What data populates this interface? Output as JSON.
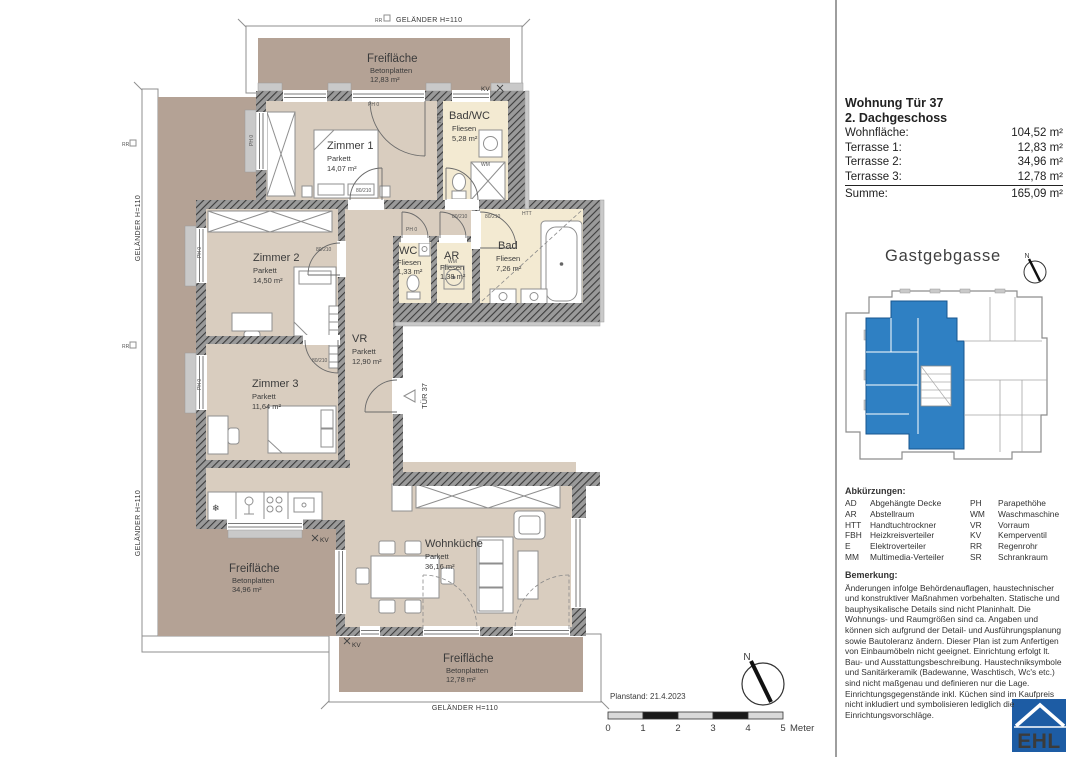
{
  "colors": {
    "terrace": "#b4a295",
    "room": "#d9cdbf",
    "wet": "#f3ead2",
    "unit_blue": "#2f80c3",
    "logo_blue": "#1d5ca4"
  },
  "plan": {
    "rooms": [
      {
        "name": "Zimmer 1",
        "floor": "Parkett",
        "area": "14,07 m²"
      },
      {
        "name": "Bad/WC",
        "floor": "Fliesen",
        "area": "5,28 m²"
      },
      {
        "name": "Zimmer 2",
        "floor": "Parkett",
        "area": "14,50 m²"
      },
      {
        "name": "WC",
        "floor": "Fliesen",
        "area": "1,33 m²"
      },
      {
        "name": "AR",
        "floor": "Fliesen",
        "area": "1,38 m²"
      },
      {
        "name": "Bad",
        "floor": "Fliesen",
        "area": "7,26 m²"
      },
      {
        "name": "VR",
        "floor": "Parkett",
        "area": "12,90 m²"
      },
      {
        "name": "Zimmer 3",
        "floor": "Parkett",
        "area": "11,64 m²"
      },
      {
        "name": "Wohnküche",
        "floor": "Parkett",
        "area": "36,16 m²"
      }
    ],
    "terraces": [
      {
        "name": "Freifläche",
        "material": "Betonplatten",
        "area": "12,83 m²"
      },
      {
        "name": "Freifläche",
        "material": "Betonplatten",
        "area": "34,96 m²"
      },
      {
        "name": "Freifläche",
        "material": "Betonplatten",
        "area": "12,78 m²"
      }
    ],
    "railing_label": "GELÄNDER H=110",
    "door_label": "TÜR 37",
    "marks": {
      "kv": "KV",
      "rr": "RR",
      "htt": "HTT",
      "wm": "WM",
      "ph": "PH 0",
      "door_dim": "80/210",
      "north": "N"
    },
    "planstand": "Planstand: 21.4.2023",
    "scale": {
      "ticks": [
        "0",
        "1",
        "2",
        "3",
        "4",
        "5"
      ],
      "unit": "Meter"
    }
  },
  "panel": {
    "title": "Wohnung Tür 37",
    "subtitle": "2. Dachgeschoss",
    "rows": [
      {
        "label": "Wohnfläche:",
        "value": "104,52 m²"
      },
      {
        "label": "Terrasse 1:",
        "value": "12,83 m²"
      },
      {
        "label": "Terrasse 2:",
        "value": "34,96 m²"
      },
      {
        "label": "Terrasse 3:",
        "value": "12,78 m²"
      }
    ],
    "total": {
      "label": "Summe:",
      "value": "165,09 m²"
    },
    "street": "Gastgebgasse"
  },
  "abbreviations": {
    "title": "Abkürzungen:",
    "items": [
      {
        "abbr": "AD",
        "term": "Abgehängte Decke"
      },
      {
        "abbr": "PH",
        "term": "Parapethöhe"
      },
      {
        "abbr": "AR",
        "term": "Abstellraum"
      },
      {
        "abbr": "WM",
        "term": "Waschmaschine"
      },
      {
        "abbr": "HTT",
        "term": "Handtuchtrockner"
      },
      {
        "abbr": "VR",
        "term": "Vorraum"
      },
      {
        "abbr": "FBH",
        "term": "Heizkreisverteiler"
      },
      {
        "abbr": "KV",
        "term": "Kemperventil"
      },
      {
        "abbr": "E",
        "term": "Elektroverteiler"
      },
      {
        "abbr": "RR",
        "term": "Regenrohr"
      },
      {
        "abbr": "MM",
        "term": "Multimedia-Verteiler"
      },
      {
        "abbr": "SR",
        "term": "Schrankraum"
      }
    ]
  },
  "remark": {
    "title": "Bemerkung:",
    "text": "Änderungen infolge Behördenauflagen, haustechnischer und konstruktiver Maßnahmen vorbehalten. Statische und bauphysikalische Details sind nicht Planinhalt. Die Wohnungs- und Raumgrößen sind ca. Angaben und können sich aufgrund der Detail- und Ausführungsplanung sowie Bautoleranz ändern. Dieser Plan ist zum Anfertigen von Einbaumöbeln nicht geeignet. Einrichtung erfolgt lt. Bau- und Ausstattungsbeschreibung. Haustechniksymbole und Sanitärkeramik (Badewanne, Waschtisch, Wc's etc.) sind nicht maßgenau und definieren nur die Lage. Einrichtungsgegenstände inkl. Küchen sind im Kaufpreis nicht inkludiert und symbolisieren lediglich die Einrichtungsvorschläge."
  },
  "logo": {
    "text": "EHL"
  }
}
